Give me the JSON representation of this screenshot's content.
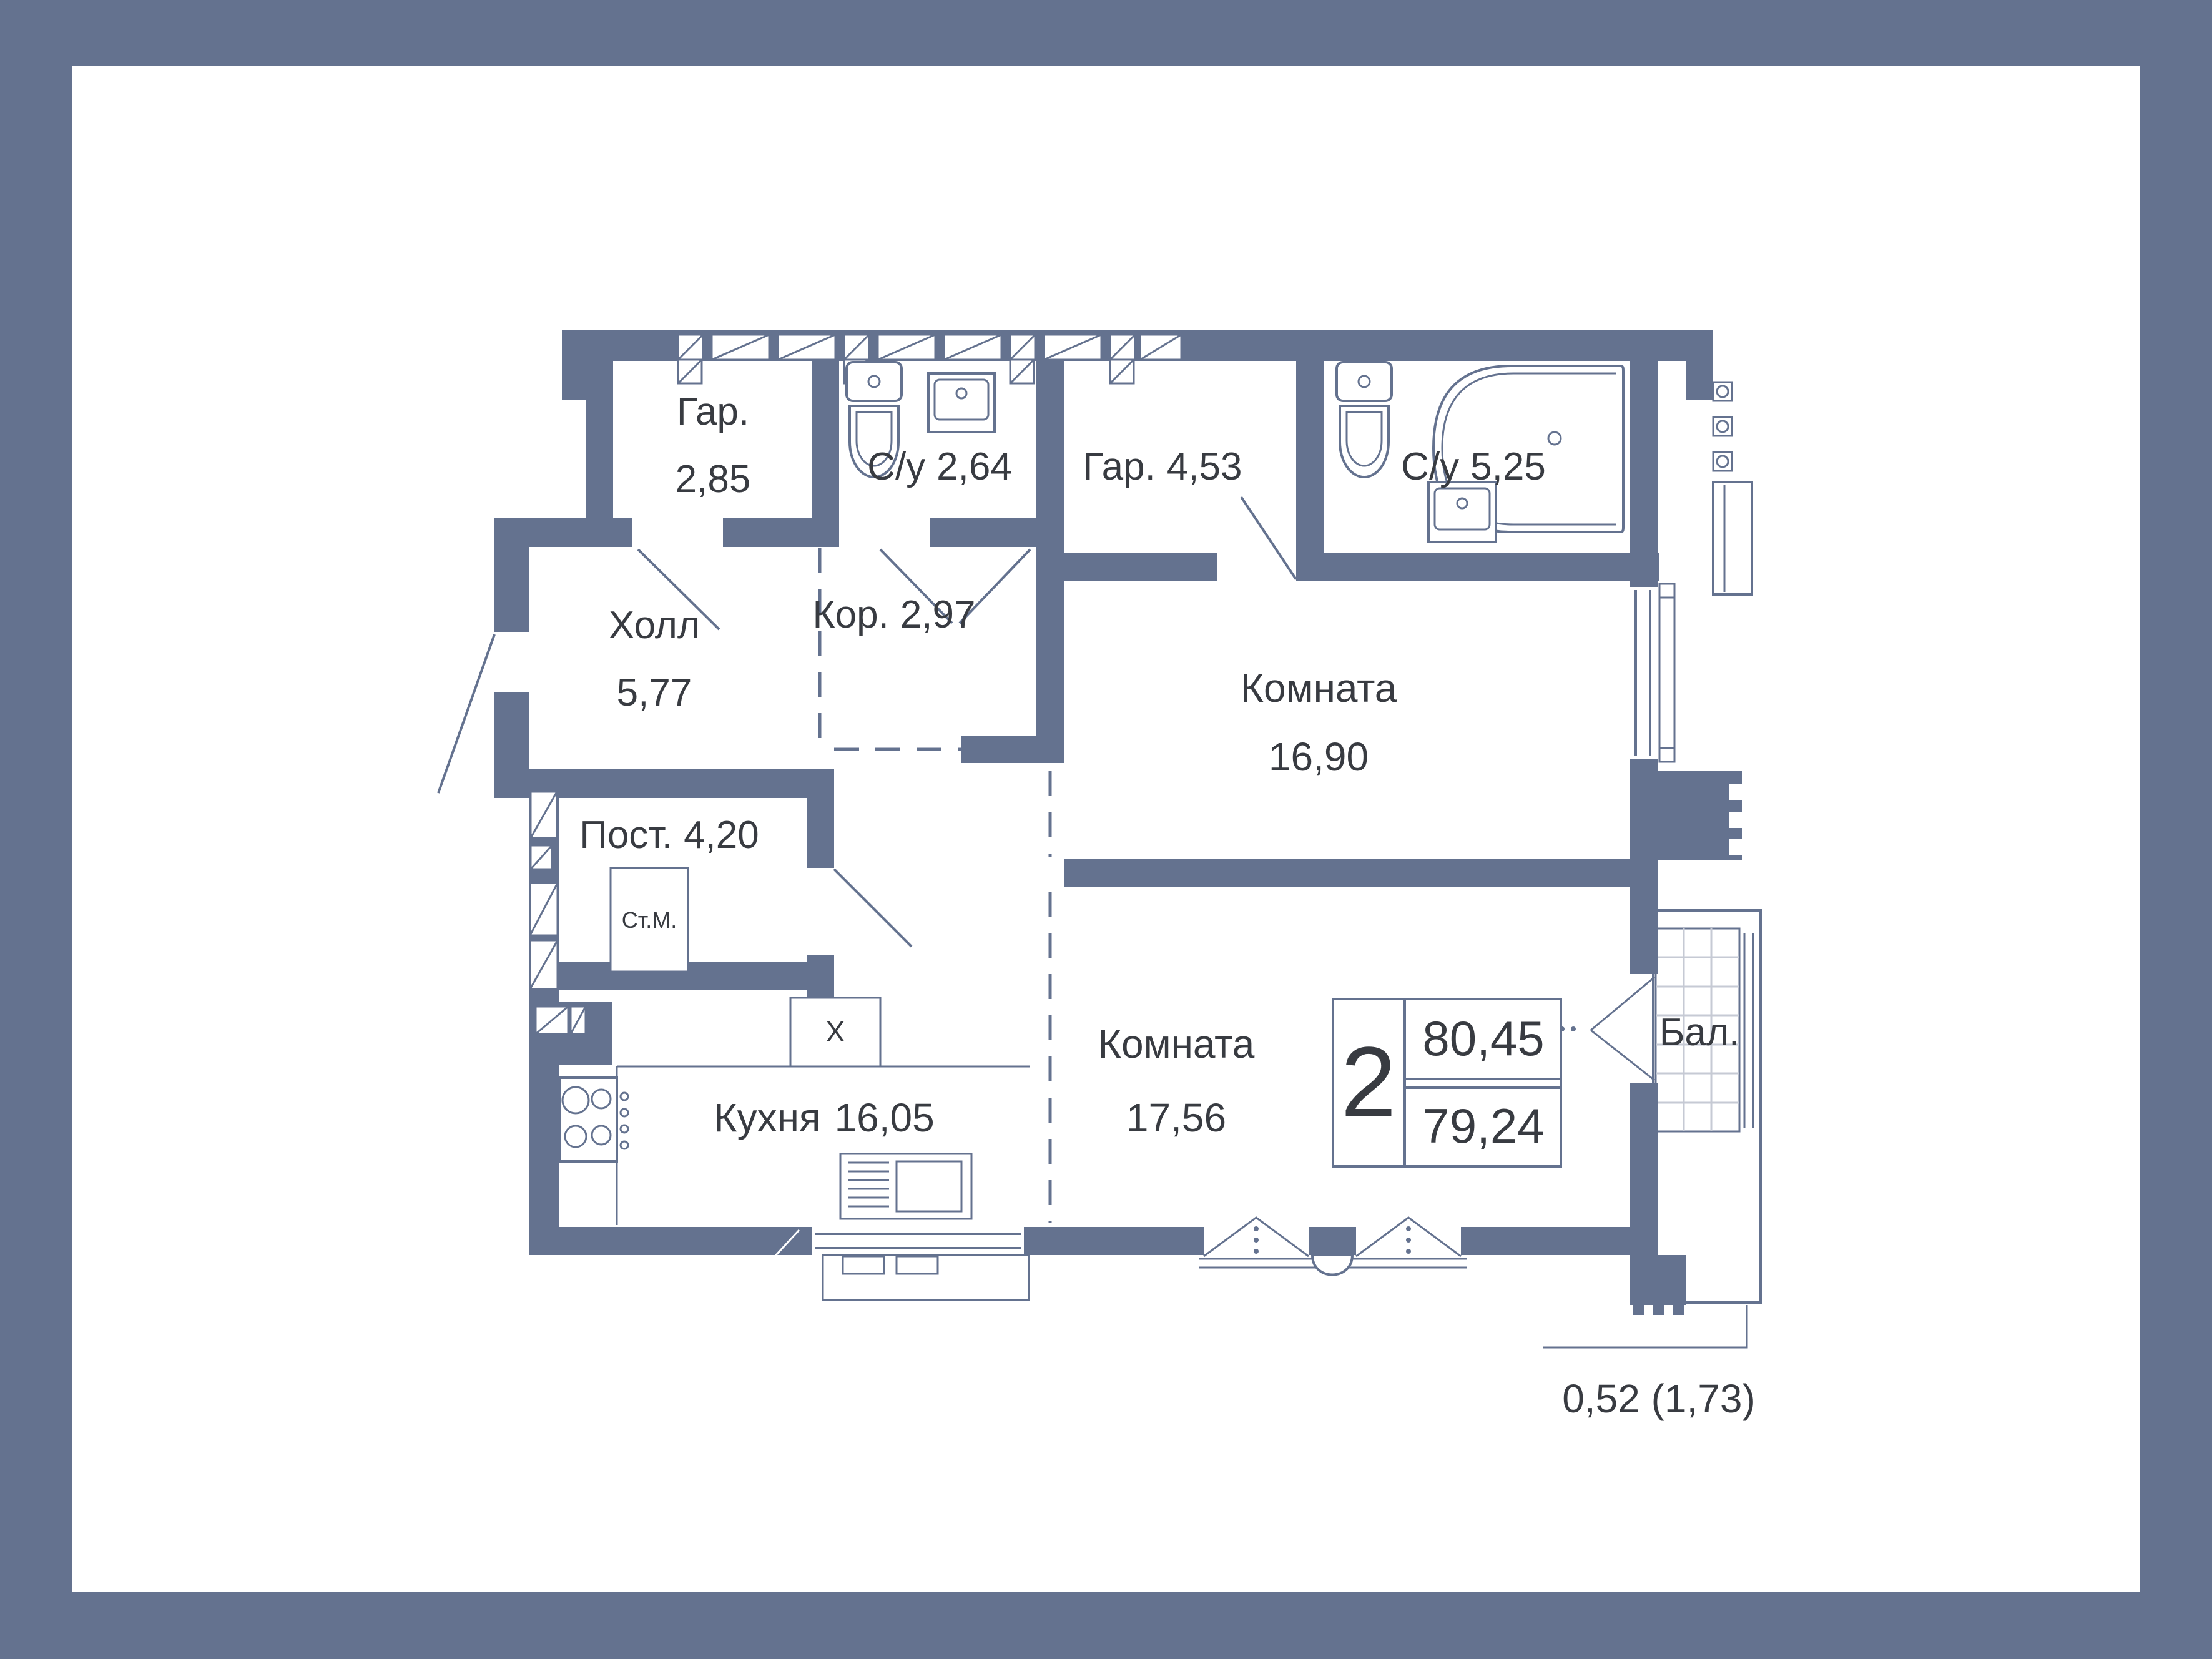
{
  "frame": {
    "border_color": "#64728F",
    "background": "#FFFFFF"
  },
  "plan": {
    "wall_color": "#64728F",
    "text_color": "#383B41",
    "rooms": [
      {
        "id": "wardrobe-1",
        "name": "Гар.",
        "area": "2,85"
      },
      {
        "id": "bathroom-1",
        "name": "С/у",
        "area": "2,64"
      },
      {
        "id": "wardrobe-2",
        "name": "Гар.",
        "area": "4,53"
      },
      {
        "id": "bathroom-2",
        "name": "С/у",
        "area": "5,25"
      },
      {
        "id": "hall",
        "name": "Холл",
        "area": "5,77"
      },
      {
        "id": "corridor",
        "name": "Кор.",
        "area": "2,97"
      },
      {
        "id": "room-1",
        "name": "Комната",
        "area": "16,90"
      },
      {
        "id": "laundry",
        "name": "Пост.",
        "area": "4,20"
      },
      {
        "id": "kitchen",
        "name": "Кухня",
        "area": "16,05"
      },
      {
        "id": "room-2",
        "name": "Комната",
        "area": "17,56"
      },
      {
        "id": "balcony",
        "name": "Бал."
      }
    ],
    "appliances": {
      "washing_machine": "Ст.М.",
      "shaft": "X"
    },
    "info_badge": {
      "rooms_count": "2",
      "area_total": "80,45",
      "area_reduced": "79,24"
    },
    "balcony_annotation": "0,52 (1,73)"
  }
}
